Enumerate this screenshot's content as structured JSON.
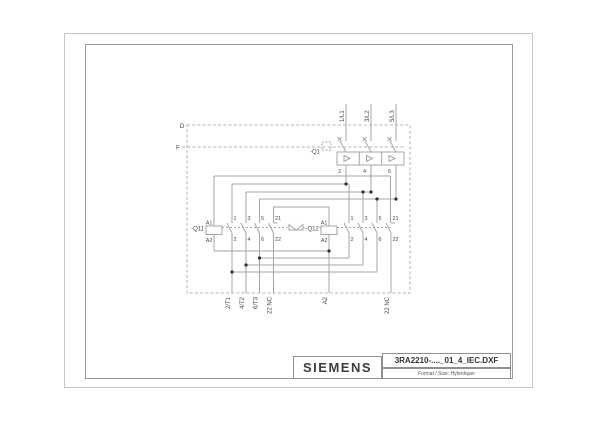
{
  "title_block": {
    "brand": "SIEMENS",
    "filename": "3RA2210-...._01_4_IEC.DXF",
    "format_line": "Format / Size: Hybridquer"
  },
  "boundary": {
    "d_label": "D",
    "f_label": "F"
  },
  "supply": {
    "l1": "1/L1",
    "l2": "3/L2",
    "l3": "5/L3"
  },
  "q1": {
    "label": "-Q1",
    "t2": "2",
    "t4": "4",
    "t6": "6"
  },
  "q11": {
    "label": "-Q11",
    "a1": "A1",
    "a2": "A2",
    "n1": "1",
    "n2": "2",
    "n3": "3",
    "n4": "4",
    "n5": "5",
    "n6": "6",
    "n21": "21",
    "n22": "22"
  },
  "q12": {
    "label": "-Q12",
    "a1": "A1",
    "a2": "A2",
    "n1": "1",
    "n2": "2",
    "n3": "3",
    "n4": "4",
    "n5": "5",
    "n6": "6",
    "n21": "21",
    "n22": "22"
  },
  "exits": {
    "t1": "2/T1",
    "t2": "4/T2",
    "t3": "6/T3",
    "nc_left": "22 NC",
    "a2": "A2",
    "nc_right": "22 NC"
  },
  "colors": {
    "wire": "#a6a6a6",
    "dash": "#b3b3b3",
    "text": "#4a4a4a",
    "dot": "#303030",
    "border_outer": "#c6c6c6",
    "border_inner": "#9b9b9b"
  }
}
